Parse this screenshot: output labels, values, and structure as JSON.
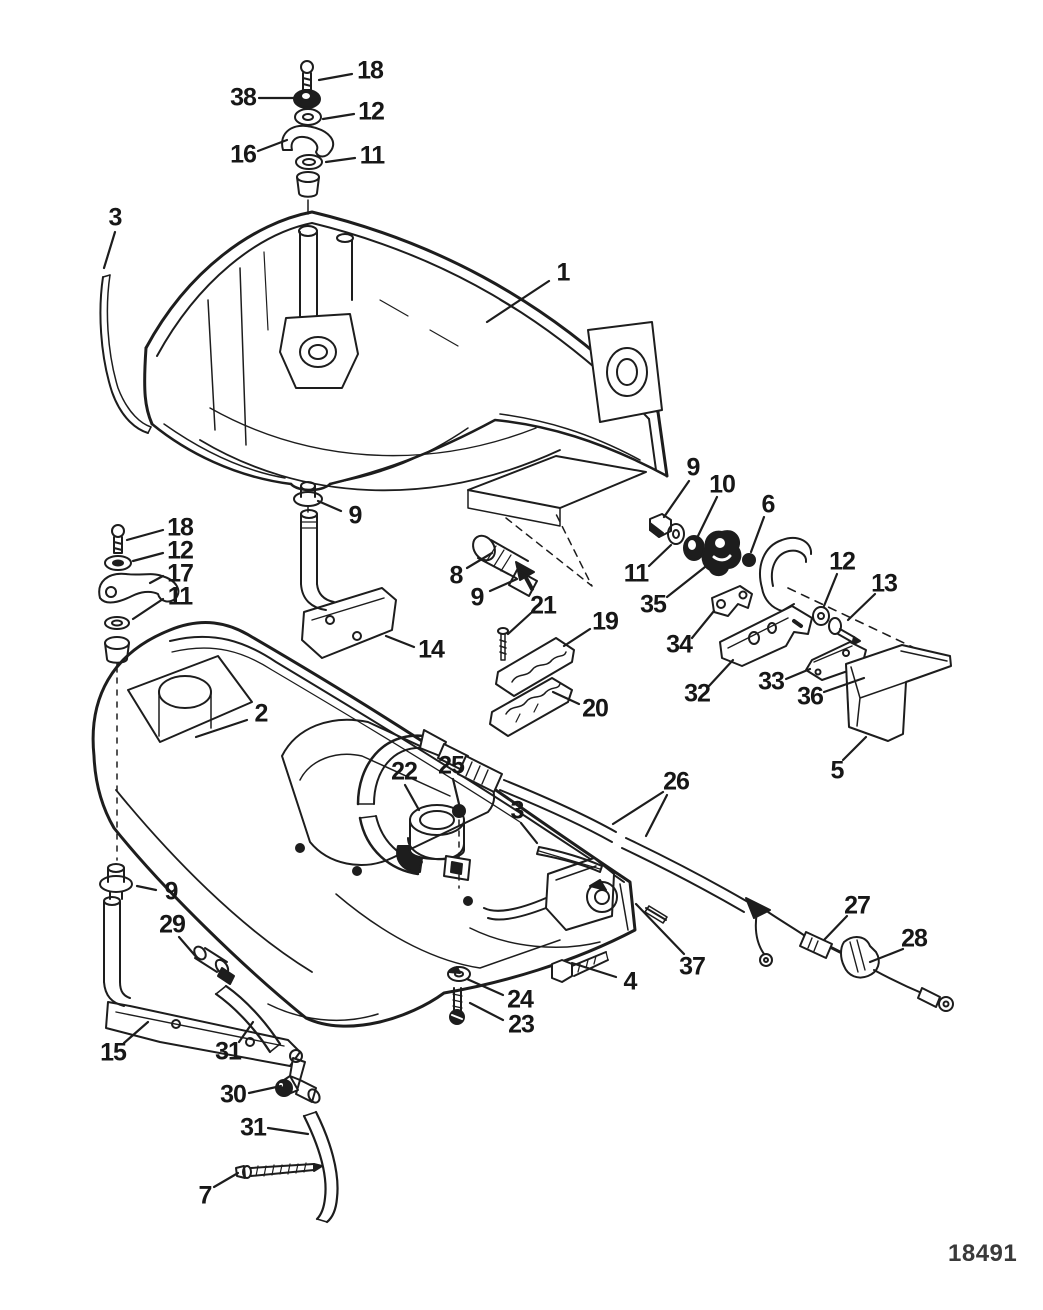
{
  "figure": {
    "drawing_number": "18491",
    "ink_color": "#1d1d1d",
    "background": "#ffffff",
    "description_visible_text_only": true
  },
  "callouts": [
    {
      "id": "18-top",
      "label": "18",
      "x": 370,
      "y": 71,
      "leaders": [
        [
          352,
          74,
          319,
          80
        ]
      ]
    },
    {
      "id": "38",
      "label": "38",
      "x": 243,
      "y": 98,
      "leaders": [
        [
          259,
          98,
          294,
          98
        ]
      ]
    },
    {
      "id": "12-top",
      "label": "12",
      "x": 371,
      "y": 112,
      "leaders": [
        [
          354,
          114,
          323,
          119
        ]
      ]
    },
    {
      "id": "16",
      "label": "16",
      "x": 243,
      "y": 155,
      "leaders": [
        [
          258,
          151,
          287,
          140
        ]
      ]
    },
    {
      "id": "11-top",
      "label": "11",
      "x": 372,
      "y": 156,
      "leaders": [
        [
          355,
          158,
          326,
          162
        ]
      ]
    },
    {
      "id": "3-left",
      "label": "3",
      "x": 115,
      "y": 218,
      "leaders": [
        [
          115,
          232,
          104,
          268
        ]
      ]
    },
    {
      "id": "1",
      "label": "1",
      "x": 563,
      "y": 273,
      "leaders": [
        [
          549,
          281,
          487,
          322
        ]
      ]
    },
    {
      "id": "9-center",
      "label": "9",
      "x": 355,
      "y": 516,
      "leaders": [
        [
          341,
          511,
          318,
          501
        ]
      ]
    },
    {
      "id": "18-left",
      "label": "18",
      "x": 180,
      "y": 528,
      "leaders": [
        [
          163,
          530,
          127,
          540
        ]
      ]
    },
    {
      "id": "12-left",
      "label": "12",
      "x": 180,
      "y": 551,
      "leaders": [
        [
          163,
          553,
          133,
          561
        ]
      ]
    },
    {
      "id": "17",
      "label": "17",
      "x": 180,
      "y": 574,
      "leaders": [
        [
          163,
          576,
          150,
          583
        ]
      ]
    },
    {
      "id": "11-left",
      "label": "11",
      "x": 180,
      "y": 597,
      "leaders": [
        [
          163,
          599,
          133,
          619
        ]
      ]
    },
    {
      "id": "14",
      "label": "14",
      "x": 431,
      "y": 650,
      "leaders": [
        [
          414,
          647,
          386,
          636
        ]
      ]
    },
    {
      "id": "8",
      "label": "8",
      "x": 456,
      "y": 576,
      "leaders": [
        [
          467,
          568,
          492,
          553
        ]
      ]
    },
    {
      "id": "9-ferrule",
      "label": "9",
      "x": 477,
      "y": 598,
      "leaders": [
        [
          490,
          591,
          517,
          579
        ]
      ]
    },
    {
      "id": "21",
      "label": "21",
      "x": 543,
      "y": 606,
      "leaders": [
        [
          531,
          613,
          508,
          634
        ]
      ]
    },
    {
      "id": "19",
      "label": "19",
      "x": 605,
      "y": 622,
      "leaders": [
        [
          590,
          629,
          564,
          646
        ]
      ]
    },
    {
      "id": "20",
      "label": "20",
      "x": 595,
      "y": 709,
      "leaders": [
        [
          579,
          704,
          553,
          692
        ]
      ]
    },
    {
      "id": "9-right",
      "label": "9",
      "x": 693,
      "y": 468,
      "leaders": [
        [
          689,
          481,
          664,
          517
        ]
      ]
    },
    {
      "id": "10",
      "label": "10",
      "x": 722,
      "y": 485,
      "leaders": [
        [
          717,
          497,
          697,
          538
        ]
      ]
    },
    {
      "id": "11-right",
      "label": "11",
      "x": 636,
      "y": 574,
      "leaders": [
        [
          649,
          566,
          671,
          545
        ]
      ]
    },
    {
      "id": "35",
      "label": "35",
      "x": 653,
      "y": 605,
      "leaders": [
        [
          667,
          597,
          705,
          567
        ]
      ]
    },
    {
      "id": "6",
      "label": "6",
      "x": 768,
      "y": 505,
      "leaders": [
        [
          764,
          517,
          751,
          552
        ]
      ]
    },
    {
      "id": "34",
      "label": "34",
      "x": 679,
      "y": 645,
      "leaders": [
        [
          692,
          638,
          714,
          611
        ]
      ]
    },
    {
      "id": "32",
      "label": "32",
      "x": 697,
      "y": 694,
      "leaders": [
        [
          709,
          686,
          733,
          660
        ]
      ]
    },
    {
      "id": "33",
      "label": "33",
      "x": 771,
      "y": 682,
      "leaders": [
        [
          786,
          679,
          810,
          669
        ]
      ]
    },
    {
      "id": "36",
      "label": "36",
      "x": 810,
      "y": 697,
      "leaders": [
        [
          824,
          692,
          864,
          678
        ]
      ]
    },
    {
      "id": "12-right",
      "label": "12",
      "x": 842,
      "y": 562,
      "leaders": [
        [
          837,
          574,
          824,
          606
        ]
      ]
    },
    {
      "id": "13",
      "label": "13",
      "x": 884,
      "y": 584,
      "leaders": [
        [
          875,
          594,
          848,
          620
        ]
      ]
    },
    {
      "id": "5",
      "label": "5",
      "x": 837,
      "y": 771,
      "leaders": [
        [
          843,
          760,
          866,
          737
        ]
      ]
    },
    {
      "id": "2",
      "label": "2",
      "x": 261,
      "y": 714,
      "leaders": [
        [
          247,
          720,
          196,
          737
        ]
      ]
    },
    {
      "id": "22",
      "label": "22",
      "x": 404,
      "y": 772,
      "leaders": [
        [
          405,
          785,
          419,
          810
        ]
      ]
    },
    {
      "id": "25",
      "label": "25",
      "x": 451,
      "y": 766,
      "leaders": [
        [
          453,
          779,
          459,
          804
        ]
      ]
    },
    {
      "id": "3-center",
      "label": "3",
      "x": 517,
      "y": 811,
      "leaders": [
        [
          521,
          823,
          537,
          843
        ]
      ]
    },
    {
      "id": "26",
      "label": "26",
      "x": 676,
      "y": 782,
      "leaders": [
        [
          663,
          792,
          613,
          824
        ],
        [
          667,
          795,
          646,
          836
        ]
      ]
    },
    {
      "id": "37",
      "label": "37",
      "x": 692,
      "y": 967,
      "leaders": [
        [
          684,
          954,
          636,
          904
        ]
      ]
    },
    {
      "id": "4",
      "label": "4",
      "x": 630,
      "y": 982,
      "leaders": [
        [
          616,
          977,
          572,
          963
        ]
      ]
    },
    {
      "id": "24",
      "label": "24",
      "x": 520,
      "y": 1000,
      "leaders": [
        [
          503,
          995,
          467,
          979
        ]
      ]
    },
    {
      "id": "23",
      "label": "23",
      "x": 521,
      "y": 1025,
      "leaders": [
        [
          503,
          1020,
          470,
          1003
        ]
      ]
    },
    {
      "id": "27",
      "label": "27",
      "x": 857,
      "y": 906,
      "leaders": [
        [
          847,
          916,
          824,
          940
        ]
      ]
    },
    {
      "id": "28",
      "label": "28",
      "x": 914,
      "y": 939,
      "leaders": [
        [
          903,
          949,
          870,
          962
        ]
      ]
    },
    {
      "id": "9-bottom",
      "label": "9",
      "x": 171,
      "y": 892,
      "leaders": [
        [
          156,
          890,
          137,
          886
        ]
      ]
    },
    {
      "id": "29",
      "label": "29",
      "x": 172,
      "y": 925,
      "leaders": [
        [
          179,
          937,
          198,
          959
        ]
      ]
    },
    {
      "id": "15",
      "label": "15",
      "x": 113,
      "y": 1053,
      "leaders": [
        [
          124,
          1043,
          148,
          1022
        ]
      ]
    },
    {
      "id": "31-upper",
      "label": "31",
      "x": 228,
      "y": 1052,
      "leaders": [
        [
          239,
          1042,
          253,
          1022
        ]
      ]
    },
    {
      "id": "30",
      "label": "30",
      "x": 233,
      "y": 1095,
      "leaders": [
        [
          249,
          1093,
          281,
          1086
        ]
      ]
    },
    {
      "id": "31-lower",
      "label": "31",
      "x": 253,
      "y": 1128,
      "leaders": [
        [
          268,
          1128,
          308,
          1134
        ]
      ]
    },
    {
      "id": "7",
      "label": "7",
      "x": 205,
      "y": 1196,
      "leaders": [
        [
          214,
          1187,
          238,
          1173
        ]
      ]
    }
  ]
}
